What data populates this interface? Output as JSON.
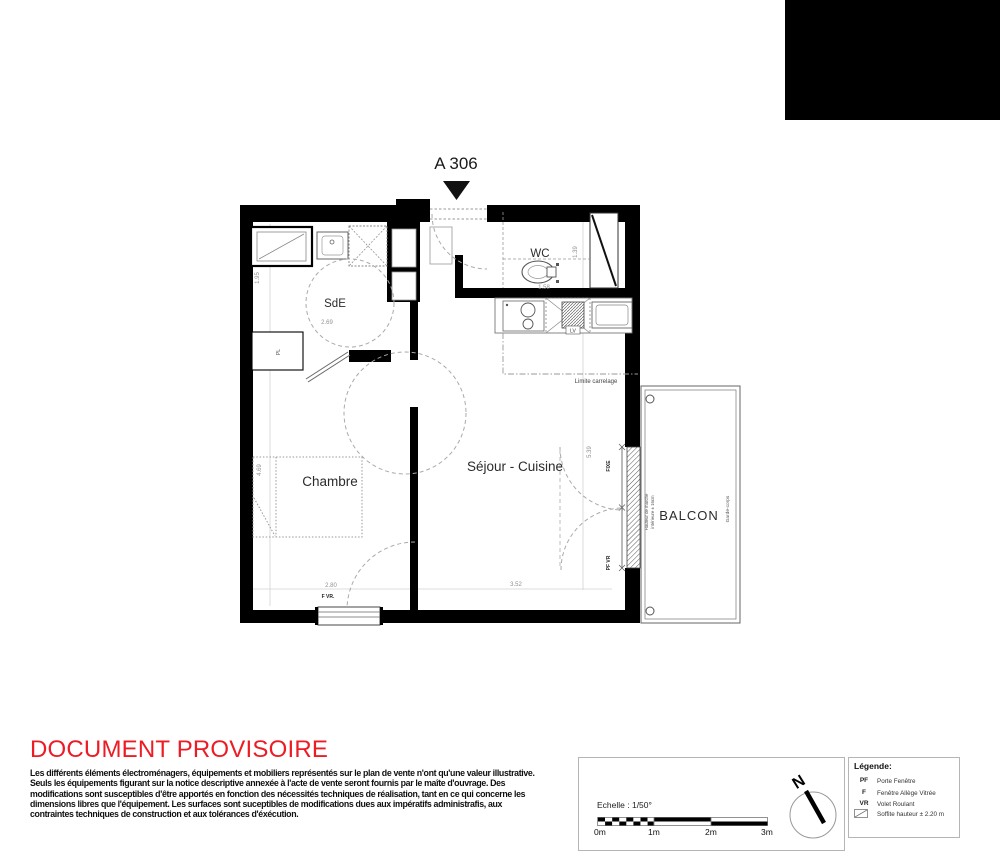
{
  "colors": {
    "accent_red": "#ed1c24",
    "wall_black": "#000000",
    "line_gray": "#aaaaaa"
  },
  "header": {
    "unit_label": "A 306"
  },
  "plan": {
    "rooms": {
      "sde": {
        "name": "SdE"
      },
      "wc": {
        "name": "WC"
      },
      "chambre": {
        "name": "Chambre"
      },
      "sejour": {
        "name": "Séjour - Cuisine"
      },
      "balcon": {
        "name": "BALCON"
      }
    },
    "dimensions": {
      "sde_width": "2.69",
      "sde_height": "1.95",
      "wc_width": "1.58",
      "wc_height": "1.39",
      "chambre_width": "2.80",
      "chambre_height": "4.69",
      "sejour_width": "3.52",
      "sejour_height": "5.39"
    },
    "labels": {
      "limite_carrelage": "Limite carrelage",
      "hauteur_marche_1": "Hauteur de marche",
      "hauteur_marche_2": "intérieure ± 16cm",
      "garde_corps": "Garde-corps",
      "placard": "PL",
      "lave_vaisselle": "LV",
      "window_f_vr": "F VR.",
      "window_fixe": "FIXE",
      "window_pf_vr": "PF VR"
    }
  },
  "footer": {
    "watermark": "DOCUMENT PROVISOIRE",
    "disclaimer": [
      "Les différents éléments électroménagers, équipements et mobiliers représentés sur le plan de vente n'ont qu'une valeur illustrative.",
      "Seuls les équipements figurant sur la notice descriptive annexée à l'acte de vente seront fournis par le maîte d'ouvrage. Des",
      "modifications sont susceptibles d'être apportés en fonction des nécessités techniques de réalisation, tant en ce qui concerne les",
      "dimensions libres que l'équipement. Les surfaces sont suceptibles de modifications dues aux impératifs administrafis, aux",
      "contraintes techniques de construction et aux tolérances d'éxécution."
    ],
    "scale": {
      "label": "Echelle : 1/50°",
      "ticks": [
        "0m",
        "1m",
        "2m",
        "3m"
      ]
    },
    "north_label": "N",
    "legend": {
      "title": "Légende:",
      "items": [
        {
          "abbr": "PF",
          "label": "Porte Fenêtre"
        },
        {
          "abbr": "F",
          "label": "Fenêtre Allège Vitrée"
        },
        {
          "abbr": "VR",
          "label": "Volet Roulant"
        },
        {
          "abbr": "",
          "label": "Soffite hauteur ± 2.20 m"
        }
      ]
    }
  }
}
